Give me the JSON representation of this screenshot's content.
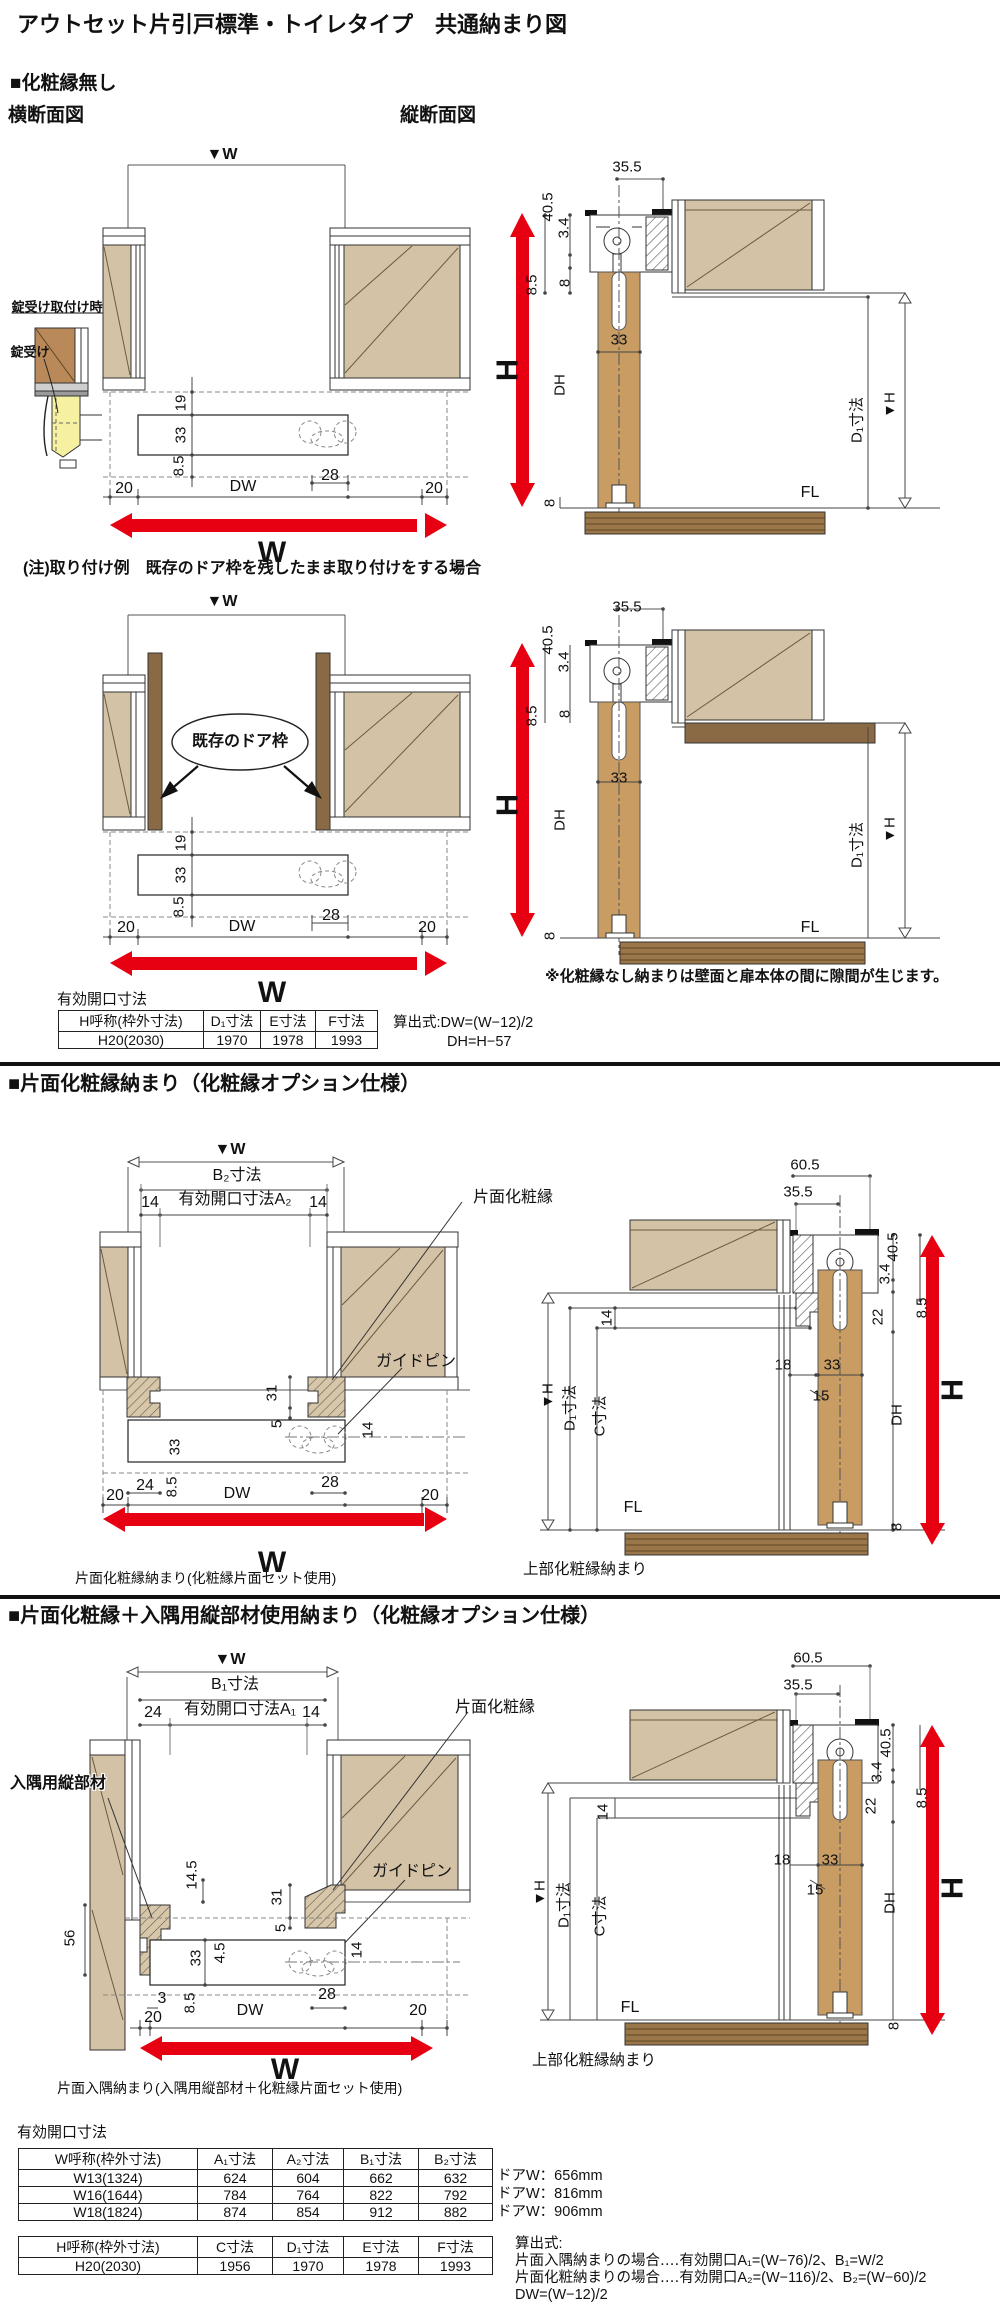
{
  "page": {
    "title": "アウトセット片引戸標準・トイレタイプ　共通納まり図"
  },
  "colors": {
    "wall_tan": "#d4c2a6",
    "door_wood": "#c89c62",
    "dark_wood": "#8a6a45",
    "floor_wood": "#9a7648",
    "lock_yellow": "#f6f1a0",
    "accent_red": "#e60012",
    "line_dark": "#333333"
  },
  "s1": {
    "heading": "■化粧縁無し",
    "view_left": "横断面図",
    "view_right": "縦断面図",
    "note": "(注)取り付け例　既存のドア枠を残したまま取り付けをする場合",
    "gap_note": "※化粧縁なし納まりは壁面と扉本体の間に隙間が生じます。",
    "lock": {
      "title": "錠受け取付け時",
      "label": "錠受け"
    },
    "planA": {
      "wmark": "▼W",
      "d19": "19",
      "d33": "33",
      "d85": "8.5",
      "d20l": "20",
      "dw": "DW",
      "d28": "28",
      "d20r": "20",
      "w": "W"
    },
    "vertB": {
      "d355": "35.5",
      "d405": "40.5",
      "d34": "3.4",
      "d85": "8.5",
      "d8t": "8",
      "d33": "33",
      "dh": "DH",
      "h": "H",
      "d1": "D₁寸法",
      "hmark": "▼H",
      "fl": "FL",
      "d8b": "8"
    },
    "planC": {
      "frame_label": "既存のドア枠",
      "wmark": "▼W",
      "d19": "19",
      "d33": "33",
      "d85": "8.5",
      "d20l": "20",
      "dw": "DW",
      "d28": "28",
      "d20r": "20",
      "w": "W"
    },
    "vertD": {
      "d355": "35.5",
      "d405": "40.5",
      "d34": "3.4",
      "d85": "8.5",
      "d8t": "8",
      "d33": "33",
      "dh": "DH",
      "h": "H",
      "d1": "D₁寸法",
      "hmark": "▼H",
      "fl": "FL",
      "d8b": "8"
    },
    "table": {
      "title": "有効開口寸法",
      "headers": [
        "H呼称(枠外寸法)",
        "D₁寸法",
        "E寸法",
        "F寸法"
      ],
      "rows": [
        [
          "H20(2030)",
          "1970",
          "1978",
          "1993"
        ]
      ]
    },
    "formulas": [
      "算出式:DW=(W−12)/2",
      "DH=H−57"
    ]
  },
  "s2": {
    "heading": "■片面化粧縁納まり（化粧縁オプション仕様）",
    "planE": {
      "wmark": "▼W",
      "b2": "B₂寸法",
      "d14l": "14",
      "a2": "有効開口寸法A₂",
      "d14r": "14",
      "edge": "片面化粧縁",
      "guide": "ガイドピン",
      "d31": "31",
      "d5": "5",
      "d33": "33",
      "d24": "24",
      "d85": "8.5",
      "dw": "DW",
      "d28": "28",
      "d14p": "14",
      "d20l": "20",
      "d20r": "20",
      "w": "W"
    },
    "vertF": {
      "d605": "60.5",
      "d355": "35.5",
      "d405": "40.5",
      "d34": "3.4",
      "d22": "22",
      "d85": "8.5",
      "d14": "14",
      "d18": "18",
      "d33": "33",
      "d15": "15",
      "dh": "DH",
      "h": "H",
      "hmark": "▼H",
      "d1": "D₁寸法",
      "c": "C寸法",
      "fl": "FL",
      "d8": "8"
    },
    "caption_left": "片面化粧縁納まり(化粧縁片面セット使用)",
    "caption_right": "上部化粧縁納まり"
  },
  "s3": {
    "heading": "■片面化粧縁＋入隅用縦部材使用納まり（化粧縁オプション仕様）",
    "planG": {
      "wmark": "▼W",
      "b1": "B₁寸法",
      "d24": "24",
      "a1": "有効開口寸法A₁",
      "d14r": "14",
      "corner": "入隅用縦部材",
      "edge": "片面化粧縁",
      "guide": "ガイドピン",
      "d145": "14.5",
      "d56": "56",
      "d31": "31",
      "d5": "5",
      "d33": "33",
      "d45": "4.5",
      "d14p": "14",
      "d3": "3",
      "d20l": "20",
      "d85": "8.5",
      "dw": "DW",
      "d28": "28",
      "d20r": "20",
      "w": "W"
    },
    "vertH": {
      "d605": "60.5",
      "d355": "35.5",
      "d405": "40.5",
      "d34": "3.4",
      "d22": "22",
      "d85": "8.5",
      "d14": "14",
      "d18": "18",
      "d33": "33",
      "d15": "15",
      "dh": "DH",
      "h": "H",
      "hmark": "▼H",
      "d1": "D₁寸法",
      "c": "C寸法",
      "fl": "FL",
      "d8": "8"
    },
    "caption_left": "片面入隅納まり(入隅用縦部材＋化粧縁片面セット使用)",
    "caption_right": "上部化粧縁納まり"
  },
  "bottom": {
    "title": "有効開口寸法",
    "w_table": {
      "headers": [
        "W呼称(枠外寸法)",
        "A₁寸法",
        "A₂寸法",
        "B₁寸法",
        "B₂寸法"
      ],
      "rows": [
        [
          "W13(1324)",
          "624",
          "604",
          "662",
          "632"
        ],
        [
          "W16(1644)",
          "784",
          "764",
          "822",
          "792"
        ],
        [
          "W18(1824)",
          "874",
          "854",
          "912",
          "882"
        ]
      ],
      "notes": [
        "ドアW：656mm",
        "ドアW：816mm",
        "ドアW：906mm"
      ]
    },
    "h_table": {
      "headers": [
        "H呼称(枠外寸法)",
        "C寸法",
        "D₁寸法",
        "E寸法",
        "F寸法"
      ],
      "rows": [
        [
          "H20(2030)",
          "1956",
          "1970",
          "1978",
          "1993"
        ]
      ]
    },
    "formulas": [
      "算出式:",
      "片面入隅納まりの場合‥‥有効開口A₁=(W−76)/2、B₁=W/2",
      "片面化粧納まりの場合‥‥有効開口A₂=(W−116)/2、B₂=(W−60)/2",
      "DW=(W−12)/2"
    ]
  }
}
